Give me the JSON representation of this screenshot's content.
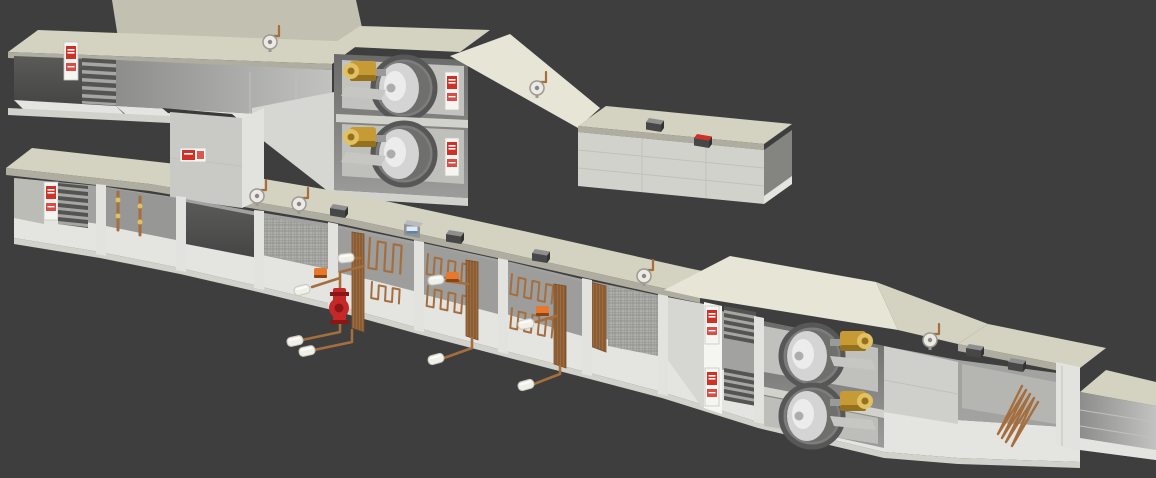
{
  "scene": {
    "description": "3D cutaway rendering of two modular air handling units with supply fans, heat-exchanger coils, filters, louver dampers, roof-mounted sensors and copper piping, on a dark grey background",
    "background": "#3e3e3e",
    "width": 1156,
    "height": 478
  },
  "palette": {
    "background": "#3e3e3e",
    "roof": "#d4d3c1",
    "roofLight": "#e6e5d6",
    "roofDark": "#c2c1b1",
    "roofFascia": "#aeada0",
    "casing": "#d2d2cd",
    "casingShade": "#bcbcb7",
    "casingBright": "#e2e2de",
    "interior": "#a4a4a2",
    "interiorDark": "#636361",
    "opening": "#4e4e4e",
    "floor": "#e4e4e1",
    "slat": "#a6a6a3",
    "slatDark": "#545452",
    "copper": "#a56e3e",
    "copperDark": "#7c4f28",
    "brass": "#c69b36",
    "brassDark": "#95701f",
    "brassLight": "#e2c163",
    "capWhite": "#f0f0e8",
    "capEdge": "#c7c7be",
    "orange": "#e8782c",
    "orangeDark": "#8a4512",
    "pumpRed": "#c62828",
    "pumpRedDark": "#891717",
    "labelWhite": "#f5f5f2",
    "labelRed": "#d22f27",
    "fanRing": "#575757",
    "fanBody": "#7d7d7d",
    "fanCone": "#d4d4d4",
    "fanConeHi": "#ececec",
    "sensorDark": "#474747",
    "sensorTop": "#8f8f8f",
    "gaugeFace": "#eceae3",
    "seam": "#c1c1bc",
    "screen": "#dfe9ef",
    "screenBlue": "#5b87a6",
    "meshBase": "#aeaeab",
    "meshLine": "#8b8b88"
  },
  "parts": {
    "top_unit": "Upper air handling unit, cutaway view",
    "bottom_unit": "Lower air handling unit, cutaway view",
    "intake_hood": "Intake hood with roof overhang",
    "intake_damper": "Inlet louver damper",
    "plenum": "Inlet plenum section",
    "drop_duct": "Vertical connecting duct between units",
    "fan_cabinet": "Supply fan section with stacked plug fans",
    "supply_fan": "Centrifugal supply fan",
    "fan_motor": "Brass fan motor",
    "warning_label": "Red safety / nameplate label",
    "transition": "Discharge transition hood",
    "discharge_duct": "Discharge duct",
    "duct_sensor": "Duct-mounted sensor box",
    "pressure_gauge": "Gauge with copper impulse line",
    "controller": "Unit controller with display",
    "mixing_section": "Mixing box section",
    "filter_section": "Filter section",
    "coil_section": "Heat-exchanger coil section",
    "coil": "Copper serpentine coil",
    "coil_header": "Finned copper coil header",
    "pipe_cap": "Insulated pipe stub with white cap",
    "valve_actuator": "Orange control-valve actuator",
    "pump": "Red circulation pump",
    "heater_section": "Heater bank section with warning labels",
    "humidifier_coil": "Copper coil in discharge section",
    "outlet_duct": "Outlet duct stub",
    "damper_rod": "Copper damper linkage rod",
    "divider": "Section divider frame",
    "roof_panel": "Casing top panel",
    "floor_panel": "Casing floor panel"
  }
}
